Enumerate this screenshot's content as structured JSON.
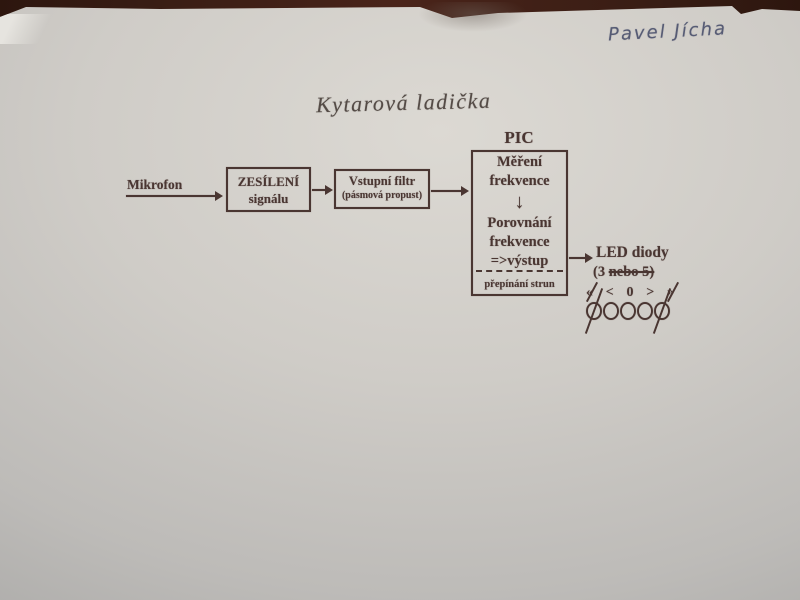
{
  "handwriting": {
    "name": "Pavel Jícha"
  },
  "title": "Kytarová ladička",
  "diagram": {
    "mikrofon": "Mikrofon",
    "zesileni": {
      "line1": "ZESÍLENÍ",
      "line2": "signálu"
    },
    "filtr": {
      "line1": "Vstupní filtr",
      "line2": "(pásmová propust)"
    },
    "pic": {
      "label": "PIC",
      "block1_line1": "Měření",
      "block1_line2": "frekvence",
      "block2_line1": "Porovnání",
      "block2_line2": "frekvence",
      "block2_line3": "=>výstup",
      "footer": "přepínání strun"
    },
    "led": {
      "title": "LED diody",
      "count_prefix": "(3 ",
      "count_struck": "nebo 5)",
      "symbols": [
        "«",
        "<",
        "0",
        ">",
        "»"
      ],
      "circle_count": 5,
      "crossed_indices": [
        0,
        4
      ]
    }
  },
  "icons": {
    "down_arrow": "↓"
  },
  "colors": {
    "ink": "#4a3632",
    "paper": "#cecbc6",
    "table": "#381d14",
    "pen_blue": "#565b74"
  }
}
